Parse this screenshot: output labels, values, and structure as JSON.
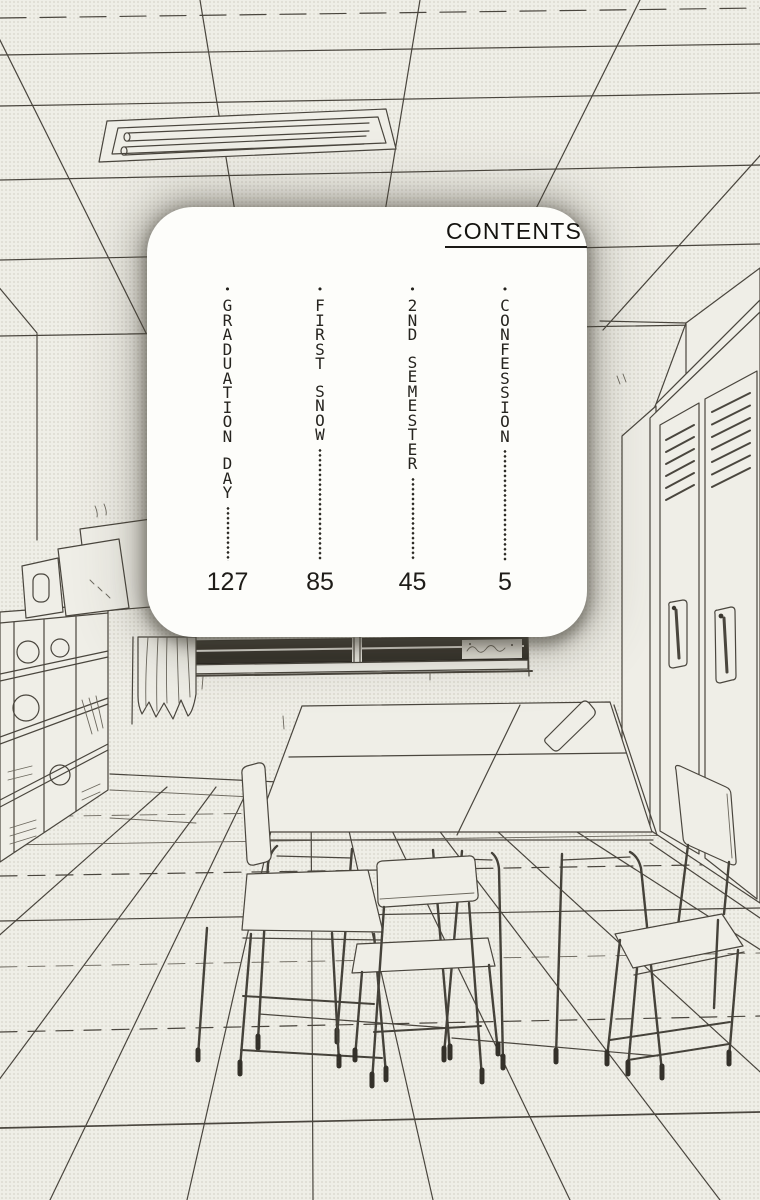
{
  "panel": {
    "heading": "CONTENTS",
    "bullet": "•",
    "entries": [
      {
        "title": "CONFESSION",
        "page": "5"
      },
      {
        "title": "2ND SEMESTER",
        "page": "45"
      },
      {
        "title": "FIRST SNOW",
        "page": "85"
      },
      {
        "title": "GRADUATION DAY",
        "page": "127"
      }
    ]
  },
  "scene": {
    "elements": [
      "ceiling-grid",
      "fluorescent-light",
      "window",
      "curtain",
      "left-wall-corner",
      "cubby-shelf",
      "art-boards",
      "lockers",
      "school-desks",
      "chairs",
      "tile-floor"
    ]
  },
  "colors": {
    "paper": "#efeee7",
    "ink": "#4a463e",
    "panel_bg": "#fdfdfa",
    "window_frame": "#35322b",
    "text": "#26241f"
  }
}
